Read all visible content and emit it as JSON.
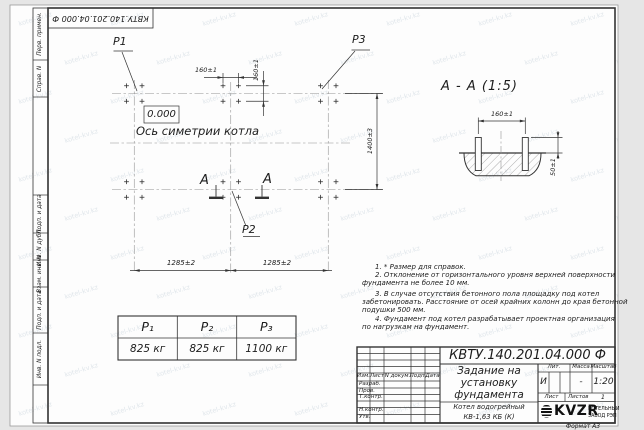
{
  "watermark": {
    "text": "kotel-kv.kz"
  },
  "stamp_top": {
    "text": "КВТУ.140.201.04.000  Ф"
  },
  "margin": {
    "labels": [
      "Перв. примен.",
      "Справ. N",
      "Подп. и дата",
      "Инв. N дубл.",
      "Взам. инв. N",
      "Подп. и дата",
      "Инв. N подл."
    ]
  },
  "plan": {
    "p1_label": "P1",
    "p2_label": "P2",
    "p3_label": "P3",
    "elevation": "0.000",
    "axis_label": "Ось симетрии котла",
    "section_letter": "А",
    "dim_160_h": "160±1",
    "dim_160_v": "160±1",
    "dim_1400": "1400±3",
    "dim_1285_left": "1285±2",
    "dim_1285_right": "1285±2"
  },
  "section": {
    "title": "А - А (1:5)",
    "dim_160": "160±1",
    "dim_50": "50±1"
  },
  "load_table": {
    "headers": [
      "P₁",
      "P₂",
      "P₃"
    ],
    "values": [
      "825 кг",
      "825 кг",
      "1100 кг"
    ]
  },
  "notes": {
    "lines": [
      "1. * Размер для справок.",
      "2. Отклонение от горизонтального уровня верхней поверхности",
      "фундамента не более 10 мм.",
      "3. В случае отсутствия бетонного пола площадку под котел",
      "забетонировать. Расстояние от осей крайних колонн до края бетонной",
      "подушки 500 мм.",
      "4. Фундамент под котел разрабатывает проектная организация",
      "по нагрузкам на фундамент."
    ]
  },
  "title_block": {
    "designation": "КВТУ.140.201.04.000  Ф",
    "doc_title_lines": [
      "Задание на",
      "установку",
      "фундамента"
    ],
    "object_lines": [
      "Котел водогрейный",
      "КВ-1,63  КБ  (К)"
    ],
    "header_cols": [
      "Изм.",
      "Лист",
      "N докум.",
      "Подп.",
      "Дата"
    ],
    "sig_rows": [
      "Разраб.",
      "Пров.",
      "Т.контр.",
      "Н.контр.",
      "Утв."
    ],
    "lit_label": "Лит.",
    "lit_value": "И",
    "mass_label": "Масса",
    "mass_value": "-",
    "scale_label": "Масштаб",
    "scale_value": "1:20",
    "sheet_label": "Лист",
    "sheets_label": "Листов",
    "sheets_value": "1",
    "company": "KVZR",
    "company_sub1": "КОТЕЛЬНЫЙ",
    "company_sub2": "ЗАВОД РЭП",
    "format_label": "Формат А3"
  }
}
